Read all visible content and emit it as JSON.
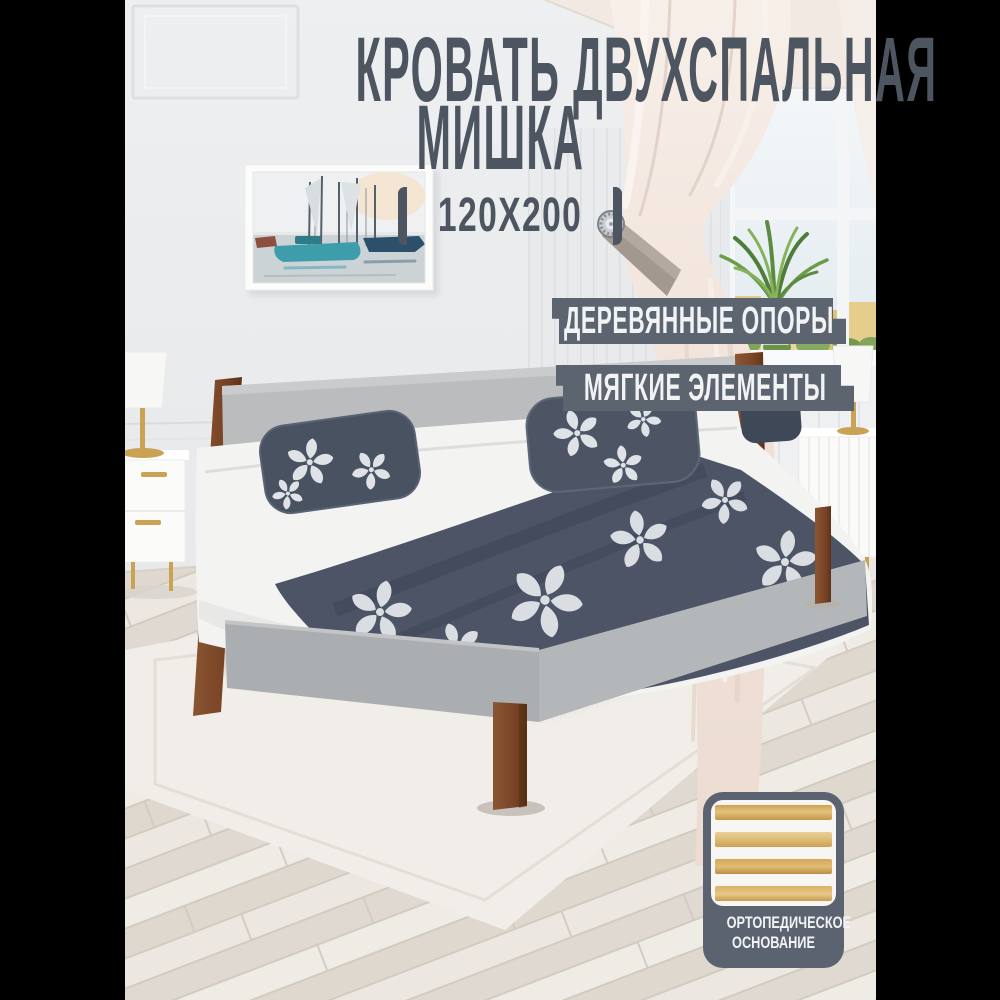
{
  "title": {
    "line1": "КРОВАТЬ ДВУХСПАЛЬНАЯ",
    "line2": "МИШКА"
  },
  "size_badge": {
    "label": "120X200",
    "left_icon": "crop-bracket-left-icon",
    "right_icon": "crop-bracket-right-icon"
  },
  "feature_badges": [
    {
      "label": "ДЕРЕВЯННЫЕ ОПОРЫ"
    },
    {
      "label": "МЯГКИЕ ЭЛЕМЕНТЫ"
    }
  ],
  "ortho_badge": {
    "line1": "ОРТОПЕДИЧЕСКОЕ",
    "line2": "ОСНОВАНИЕ",
    "icon": "bed-slats-icon"
  },
  "colors": {
    "text-dark": "#4d5560",
    "badge-bg": "#5c6470",
    "badge-text": "#f2f3f4",
    "ortho-bg": "#5b6370",
    "wood-post": "#7c4a28",
    "slat-wood": "#d3a355",
    "curtain": "#f0e2da",
    "pillow-navy": "#4a5263",
    "headboard-gray": "#babcbe",
    "pillarbox": "#000000"
  }
}
